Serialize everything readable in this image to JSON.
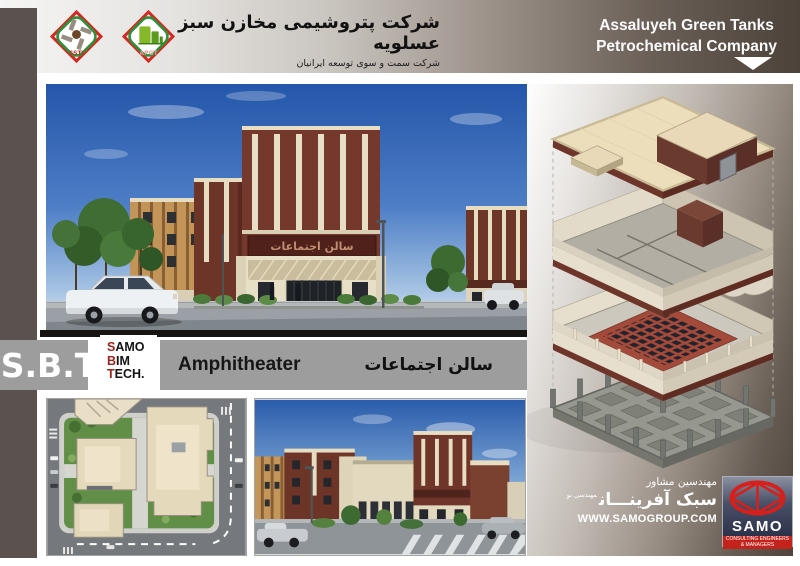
{
  "header": {
    "logo_ssti": "SSTI",
    "logo_apgt": "APGT",
    "title_fa": "شرکت پتروشیمی مخازن سبز عسلویه",
    "subtitle_fa": "شرکت سمت و سوی توسعه ایرانیان",
    "company_en_line1": "Assaluyeh Green Tanks",
    "company_en_line2": "Petrochemical Company"
  },
  "band": {
    "sbt": "S.B.T",
    "logo_lines": {
      "l1a": "S",
      "l1b": "AMO",
      "l2a": "B",
      "l2b": "IM",
      "l3a": "T",
      "l3b": "ECH."
    },
    "project_en": "Amphitheater",
    "project_fa": "سالن اجتماعات"
  },
  "main_render": {
    "building_sign_fa": "سالن اجتماعات"
  },
  "consultant": {
    "role_fa": "مهندسین مشاور",
    "name_fa": "سبک آفرینـــان",
    "name_note_fa": "مهندسی نو",
    "website": "WWW.SAMOGROUP.COM",
    "logo_text": "SAMO",
    "logo_sub1": "CONSULTING ENGINEERS",
    "logo_sub2": "& MANAGERS"
  },
  "colors": {
    "side_strip": "#5b514e",
    "header_dark": "#4b423a",
    "band_gray": "#9d9d9d",
    "sbt_red": "#9e231c",
    "samo_red": "#c4231c",
    "brick": "#73382c",
    "cream": "#e8dec6",
    "sign_band": "#50211b"
  }
}
